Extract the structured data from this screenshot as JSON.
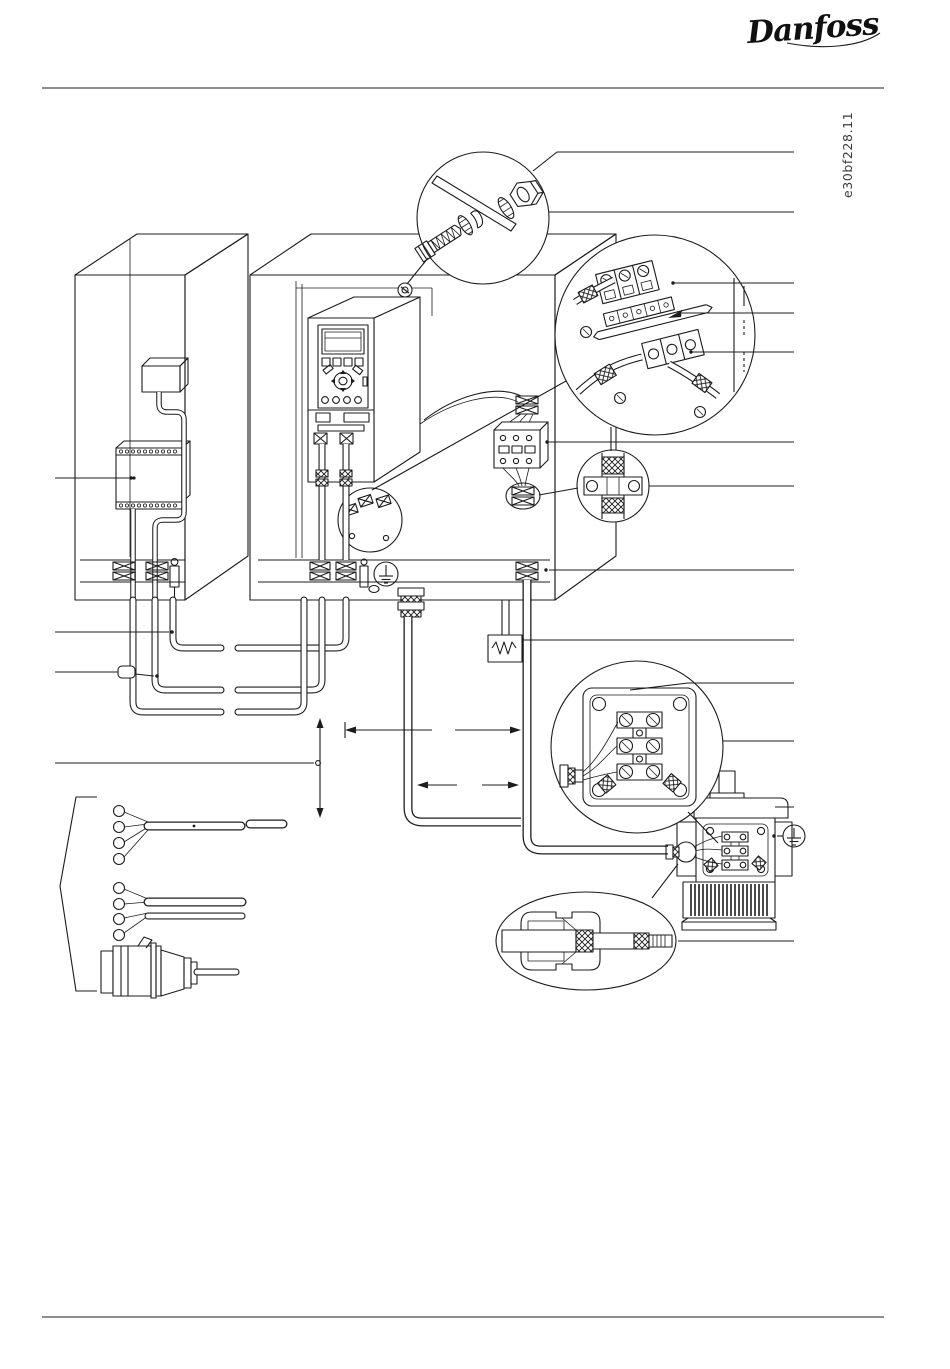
{
  "page": {
    "logo_text": "Danfoss",
    "drawing_number": "e30bf228.11",
    "background_color": "#ffffff",
    "ink_color": "#1c1c1c"
  },
  "diagram": {
    "type": "technical-line-illustration",
    "subject": "EMC-correct electrical installation: PLC cabinet and drive cabinet with frequency converter, output contactor, brake resistor, shielded motor cable, motor with terminal box, EMC cable glands, grounding hardware details and mains connection options",
    "leader_lines": {
      "right_end_x": 794,
      "right": [
        {
          "y": 212,
          "x1": 549
        },
        {
          "y": 283,
          "x1": 673
        },
        {
          "y": 313,
          "x1": 682
        },
        {
          "y": 352,
          "x1": 691
        },
        {
          "y": 442,
          "x1": 547
        },
        {
          "y": 486,
          "x1": 649
        },
        {
          "y": 570,
          "x1": 549
        },
        {
          "y": 640,
          "x1": 522
        },
        {
          "y": 741,
          "x1": 723
        },
        {
          "y": 807,
          "x1": 775
        },
        {
          "y": 941,
          "x1": 678
        }
      ],
      "left": [
        {
          "y": 478,
          "x1": 55,
          "x2": 129
        },
        {
          "y": 632,
          "x1": 55,
          "x2": 169
        },
        {
          "y": 763,
          "x1": 55,
          "x2": 314
        }
      ]
    }
  }
}
